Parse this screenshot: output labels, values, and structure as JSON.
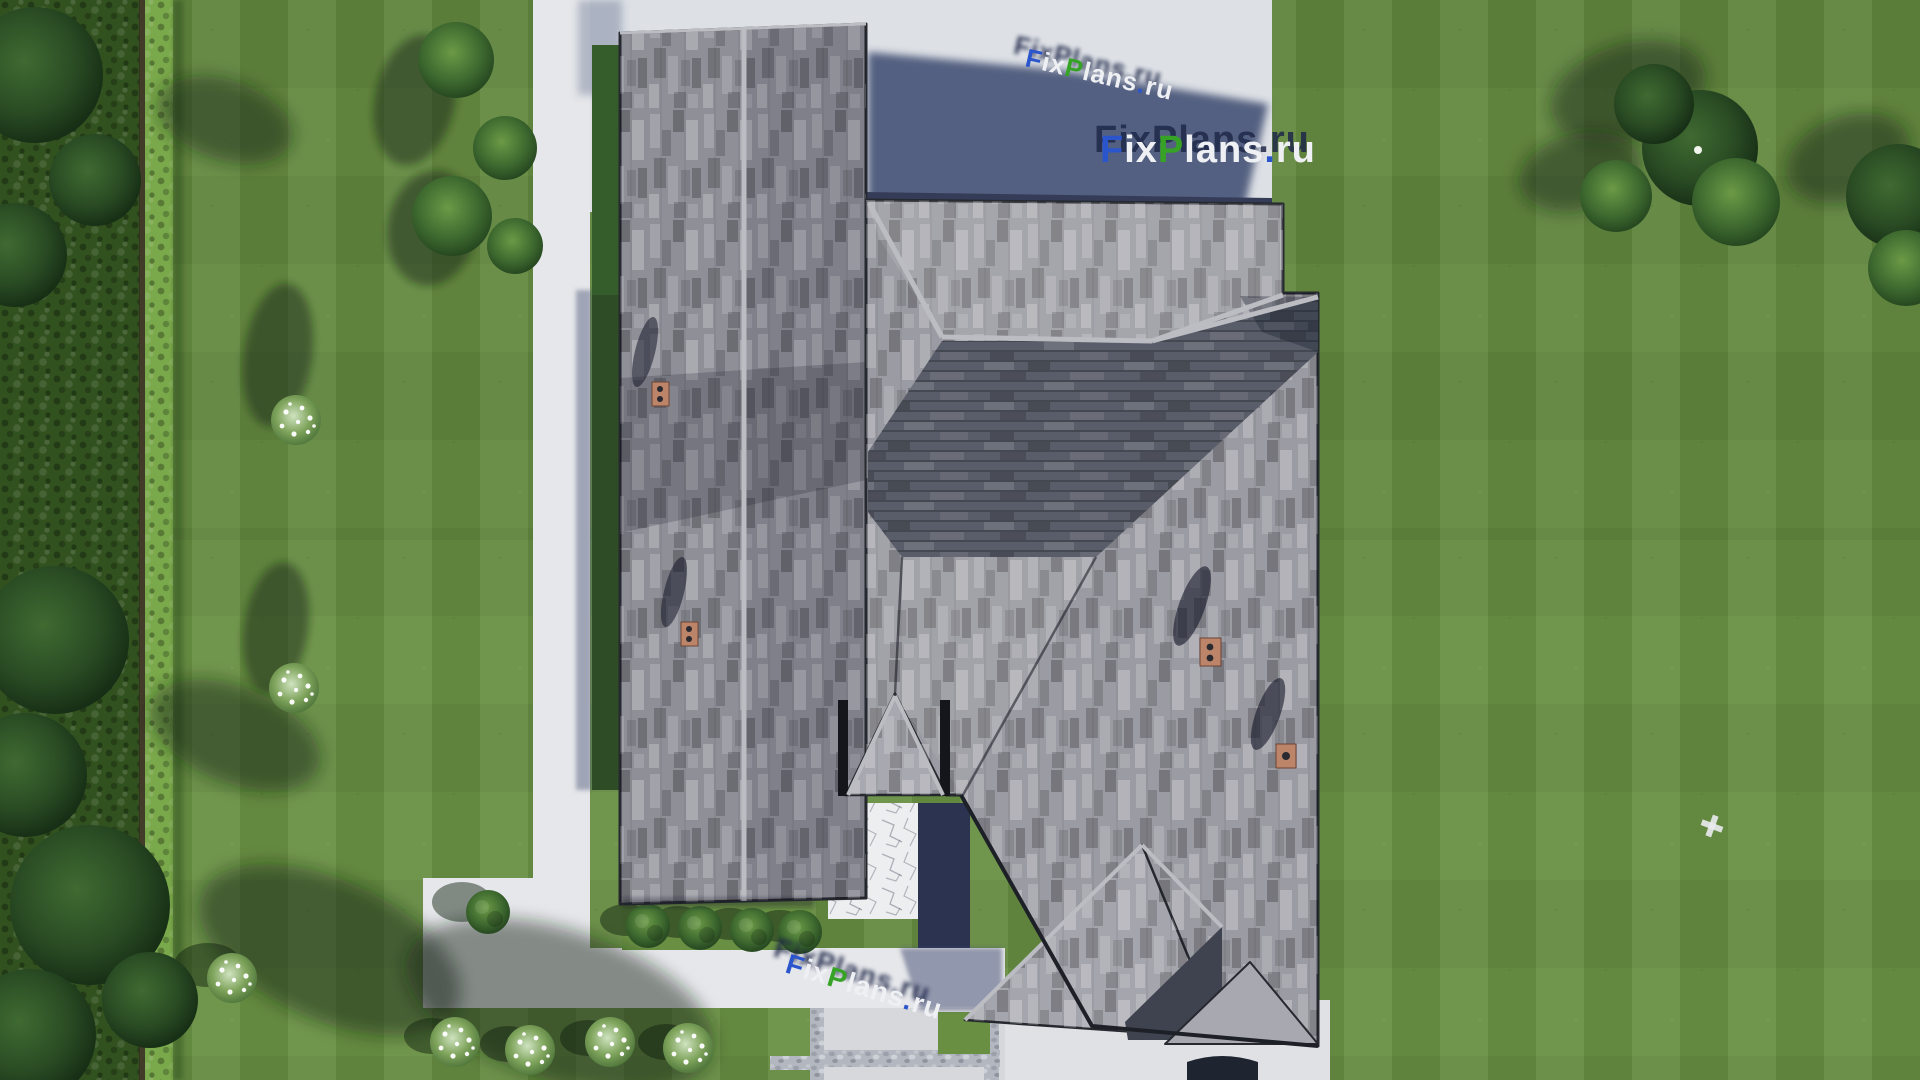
{
  "image": {
    "type": "aerial-3d-architectural-render",
    "description": "Top-down 3D visualization of a house with gray shingled hip roof, surrounded by striped lawn, conifer border, hedges, concrete walkways, shrubs and white flower bushes"
  },
  "watermark": {
    "brand_text": "FixPlans.ru",
    "segments": [
      {
        "text": "F",
        "color": "#2b55cc"
      },
      {
        "text": "ix",
        "color": "#eef0f4"
      },
      {
        "text": "P",
        "color": "#36a326"
      },
      {
        "text": "lans",
        "color": "#eef0f4"
      },
      {
        "text": ".",
        "color": "#2b55cc"
      },
      {
        "text": "ru",
        "color": "#eef0f4"
      }
    ],
    "shadow_color": "#1f2848"
  },
  "palette": {
    "lawn": "#688f42",
    "lawnStripe": "#5f873c",
    "treeDark": "#22401d",
    "hedge": "#7aa94b",
    "path": "#e6e7ea",
    "concrete": "#dde0e5",
    "concreteShadow": "#4e5a7b",
    "roofLight": "#9b9ba3",
    "roofMid": "#8e8f97",
    "roofDark": "#565a66",
    "fascia": "#26292f",
    "ridge": "#bcbdc3",
    "brick": "#bc8468",
    "shadowNavy": "#2b3350"
  },
  "scene_elements": {
    "chimneys": 4,
    "entrance": "gabled porch with stone patio",
    "vegetation": [
      "conifer border",
      "hedge wall",
      "ball shrubs",
      "white flower bushes"
    ],
    "marker_on_lawn": "small white cross"
  }
}
